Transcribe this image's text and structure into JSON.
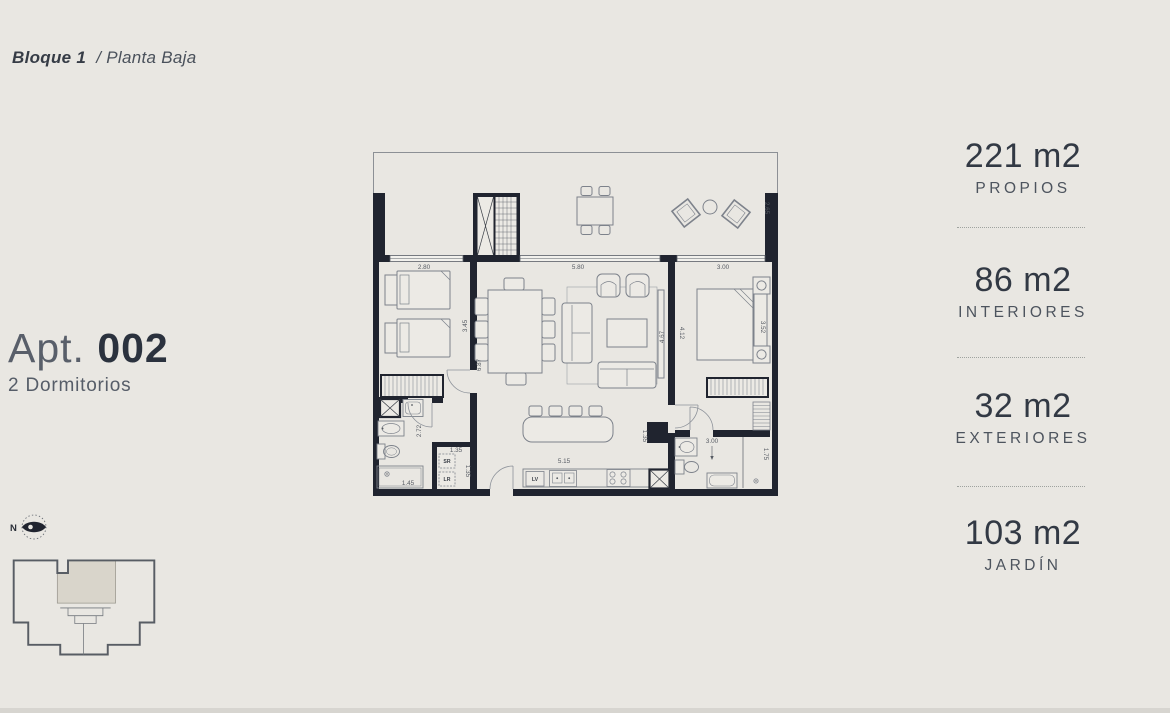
{
  "page": {
    "background": "#e9e7e2"
  },
  "header": {
    "block": "Bloque 1",
    "floor": "/ Planta Baja"
  },
  "apartment": {
    "prefix": "Apt. ",
    "number": "002",
    "type": "2 Dormitorios"
  },
  "areas": [
    {
      "value": "221 m2",
      "label": "PROPIOS"
    },
    {
      "value": "86 m2",
      "label": "INTERIORES"
    },
    {
      "value": "32 m2",
      "label": "EXTERIORES"
    },
    {
      "value": "103 m2",
      "label": "JARDÍN"
    }
  ],
  "compass": {
    "north": "N"
  },
  "floorplan": {
    "appliances": {
      "dryer": "SR",
      "washer": "LR",
      "dishwasher": "LV"
    },
    "dims": {
      "terrace_depth": "2.65",
      "bedroom_width": "2.80",
      "living_width": "5.80",
      "master_width": "3.00",
      "bedroom_depth": "3.45",
      "living_length": "6.87",
      "living_depth": "4.67",
      "master_length": "4.12",
      "master_bed_wall": "3.52",
      "bathroom_depth": "2.72",
      "shower_width": "1.45",
      "laundry_width": "1.35",
      "laundry_depth": "1.35",
      "kitchen_width": "5.15",
      "duct_width": "1.35",
      "ensuite_width": "3.00",
      "ensuite_depth": "1.75"
    }
  },
  "colors": {
    "wall": "#20242f",
    "paper": "#e9e7e2",
    "furniture_line": "#7d828b",
    "text_dark": "#323944",
    "text_muted": "#4d545e",
    "unit_highlight": "#d9d5cb"
  }
}
